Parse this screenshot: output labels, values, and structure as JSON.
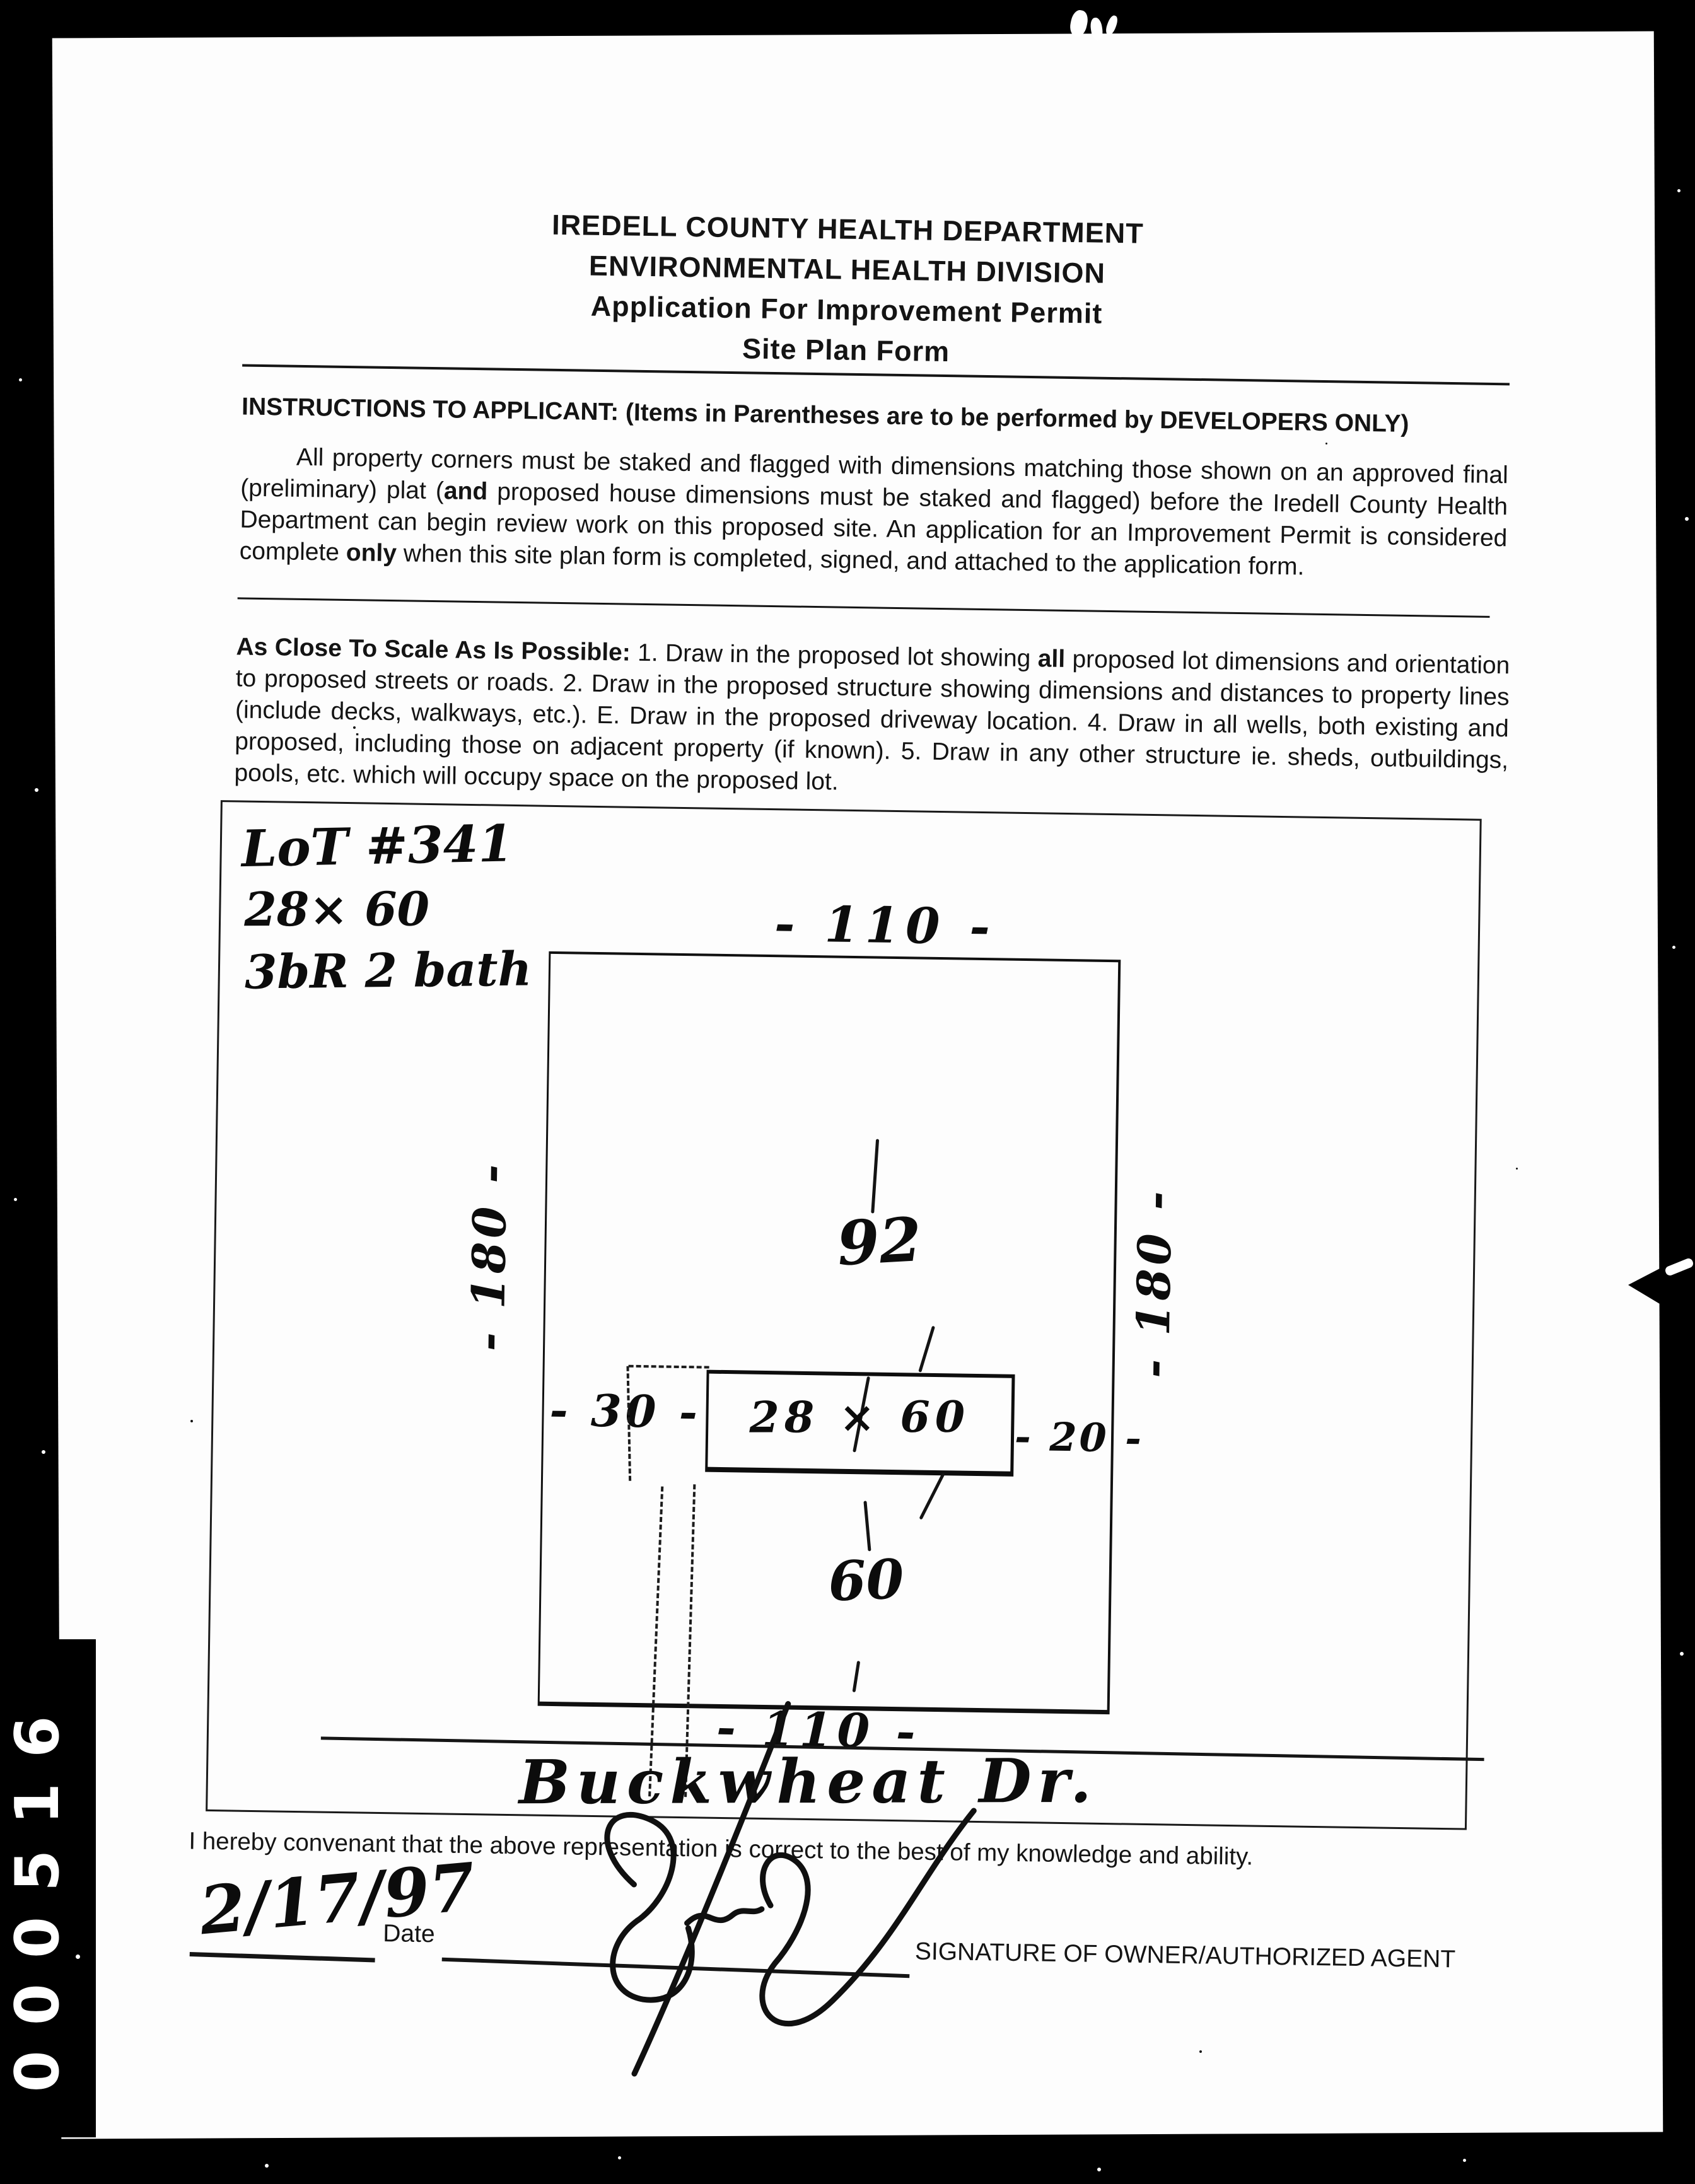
{
  "document": {
    "title_lines": [
      "IREDELL COUNTY HEALTH DEPARTMENT",
      "ENVIRONMENTAL HEALTH DIVISION",
      "Application For Improvement Permit",
      "Site Plan Form"
    ],
    "instructions_heading": "INSTRUCTIONS TO APPLICANT: (Items in Parentheses are to be performed by DEVELOPERS ONLY)",
    "instructions_body_parts": [
      {
        "t": "All property corners must be staked and flagged with dimensions matching those shown on an approved final (preliminary) plat ("
      },
      {
        "t": "and",
        "b": true
      },
      {
        "t": " proposed house dimensions must be staked and flagged) before the Iredell County Health Depart­ment can begin review work on this proposed site. An application for an Improvement Permit is considered complete "
      },
      {
        "t": "only",
        "b": true
      },
      {
        "t": " when this site plan form is completed, signed, and attached to the application form."
      }
    ],
    "scale_body_parts": [
      {
        "t": "As Close To Scale As Is Possible:",
        "b": true
      },
      {
        "t": " 1. Draw in the proposed lot showing "
      },
      {
        "t": "all",
        "b": true
      },
      {
        "t": " proposed lot dimensions and orientation to proposed streets or roads. 2. Draw in the proposed structure showing dimensions and distances to property lines (include decks, walkways, etc.). E. Draw in the proposed driveway location. 4. Draw in all wells, both existing and pro­posed, including those on adjacent property (if known). 5. Draw in any other structure ie. sheds, outbuildings, pools, etc. which will occupy space on the proposed lot."
      }
    ],
    "covenant_text": "I hereby convenant that the above representation is correct to the best of my knowledge and ability.",
    "date_label": "Date",
    "signature_label": "SIGNATURE OF OWNER/AUTHORIZED AGENT"
  },
  "site_plan": {
    "notes": [
      "LoT #341",
      "28× 60",
      "3bR 2 bath"
    ],
    "lot_width_top": "- 110 -",
    "lot_width_bottom": "- 110 -",
    "lot_depth_left": "- 180 -",
    "lot_depth_right": "- 180 -",
    "front_distance": "92",
    "house_label": "28 × 60",
    "side_distance_left": "- 30 -",
    "side_distance_right": "- 20 -",
    "rear_distance": "60",
    "road_name": "Buckwheat Dr.",
    "handwritten_date": "2/17/97"
  },
  "scan": {
    "margin_stamp": "000516",
    "background_color": "#000000",
    "paper_color": "#fdfdfd",
    "ink_color": "#111111"
  }
}
